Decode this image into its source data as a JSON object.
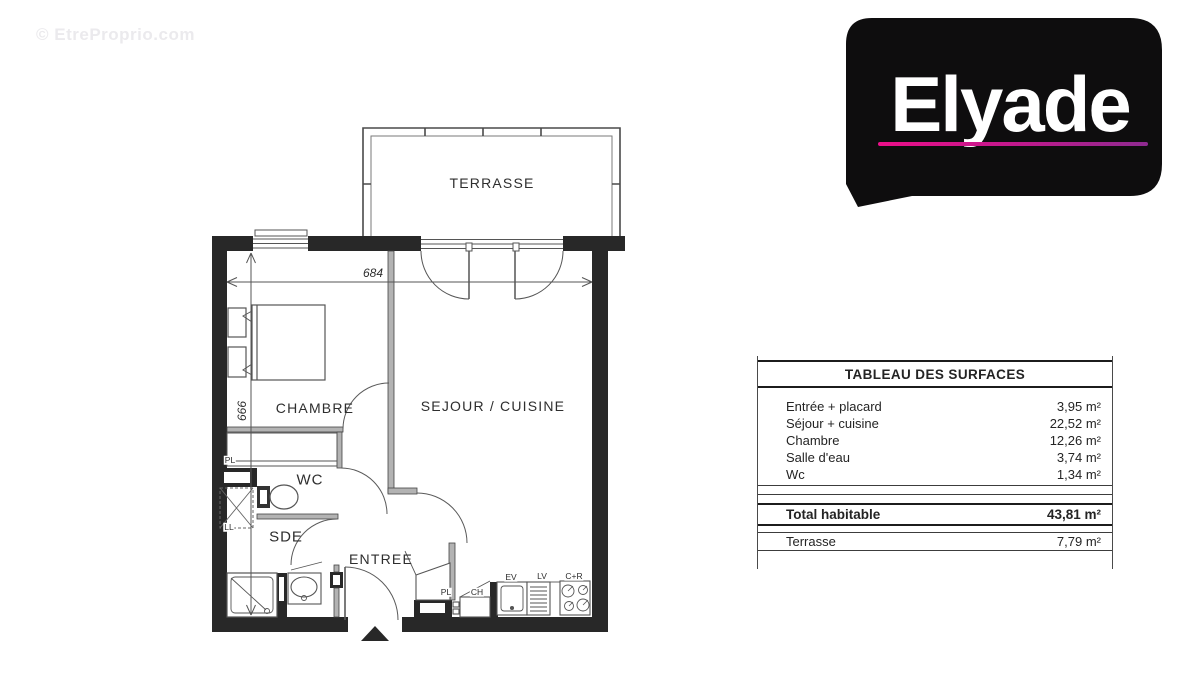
{
  "watermark": {
    "text": "© EtreProprio.com"
  },
  "logo": {
    "brand": "Elyade"
  },
  "floor_plan": {
    "room_labels": {
      "terrasse": "TERRASSE",
      "chambre": "CHAMBRE",
      "sejour_cuisine": "SEJOUR / CUISINE",
      "wc": "WC",
      "sde": "SDE",
      "entree": "ENTREE"
    },
    "fixture_labels": {
      "placard_wc": "PL",
      "lave_linge": "LL",
      "placard_entree": "PL",
      "chauffe_eau": "CH",
      "evier": "EV",
      "lave_vaisselle": "LV",
      "cuisson_refrigerateur": "C+R"
    },
    "dimensions": {
      "width_cm": "684",
      "height_cm": "666"
    }
  },
  "surface_table": {
    "title": "TABLEAU DES SURFACES",
    "rows": [
      {
        "label": "Entrée + placard",
        "value": "3,95 m²"
      },
      {
        "label": "Séjour + cuisine",
        "value": "22,52 m²"
      },
      {
        "label": "Chambre",
        "value": "12,26 m²"
      },
      {
        "label": "Salle d'eau",
        "value": "3,74 m²"
      },
      {
        "label": "Wc",
        "value": "1,34 m²"
      }
    ],
    "total": {
      "label": "Total habitable",
      "value": "43,81 m²"
    },
    "terrace": {
      "label": "Terrasse",
      "value": "7,79 m²"
    }
  }
}
